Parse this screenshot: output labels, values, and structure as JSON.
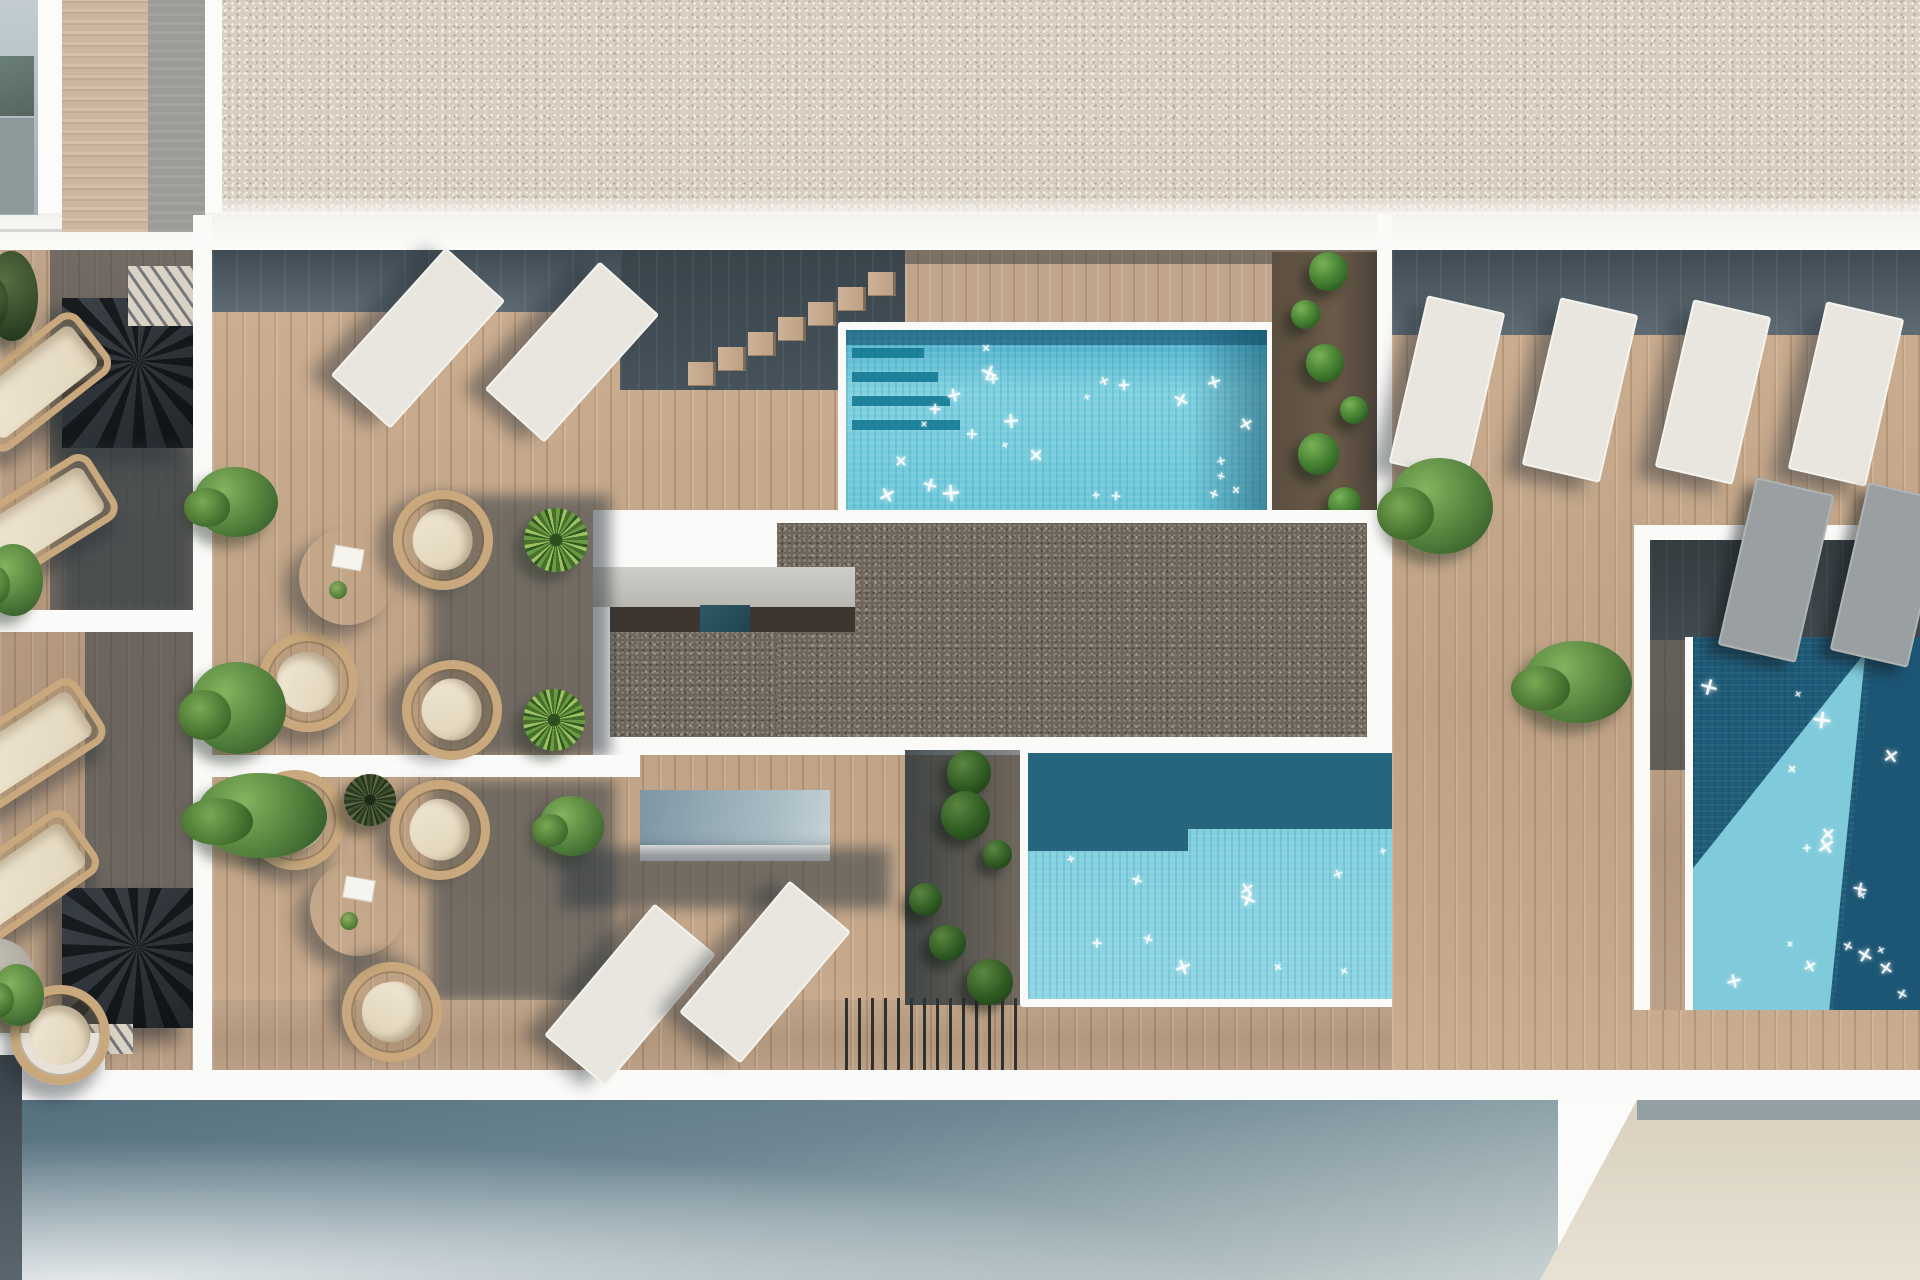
{
  "scene": {
    "title": "Rooftop terrace – aerial architectural render",
    "view": "top-down",
    "description": "Photorealistic top-down visualization of rooftop terraces: three sparkling pools, timber decks, white sun loungers, round wicker chairs with cream cushions, round timber tables, spiral stairs, box bushes, yucca plants, climbing-vine planters, a pebble roof field and a dark gravel plant-room roof."
  },
  "inventory": {
    "pools": 3,
    "sun_loungers_white": 8,
    "sun_loungers_shaded": 2,
    "wicker_daybeds": 4,
    "wicker_chairs": 7,
    "round_tables": 2,
    "side_tables": 1,
    "spiral_staircases": 2,
    "deck_stairs": 1,
    "planting_strips": 3,
    "bushes": 9,
    "yucca_plants": 3,
    "fence_sections": 1
  },
  "palette": {
    "white": "#fafaf8",
    "wood": "#b49a82",
    "rattan": "#c8a87c",
    "gravel_light": "#d8cfc1",
    "gravel_light_dot1": "#f7f3ea",
    "gravel_light_dot2": "#b9a992",
    "gravel_light_dot3": "#ebe5d7",
    "gravel_dark": "#6e665c",
    "gravel_dark_dot1": "#8d857a",
    "gravel_dark_dot2": "#4b443d",
    "gravel_dark_dot3": "#a39a8d",
    "water_light": "#7fd2e2",
    "water_mid": "#55b8d0",
    "water_dark": "#1e5a77",
    "water_step": "#157a94",
    "slate_facade_top": "#546f7d",
    "slate_facade_bottom": "#c9d2d2",
    "beige_facade": "#e2dac9",
    "shadow_deck": "#46525a",
    "panel_tan": "#cdb6a0",
    "panel_gray": "#9c9b97"
  }
}
